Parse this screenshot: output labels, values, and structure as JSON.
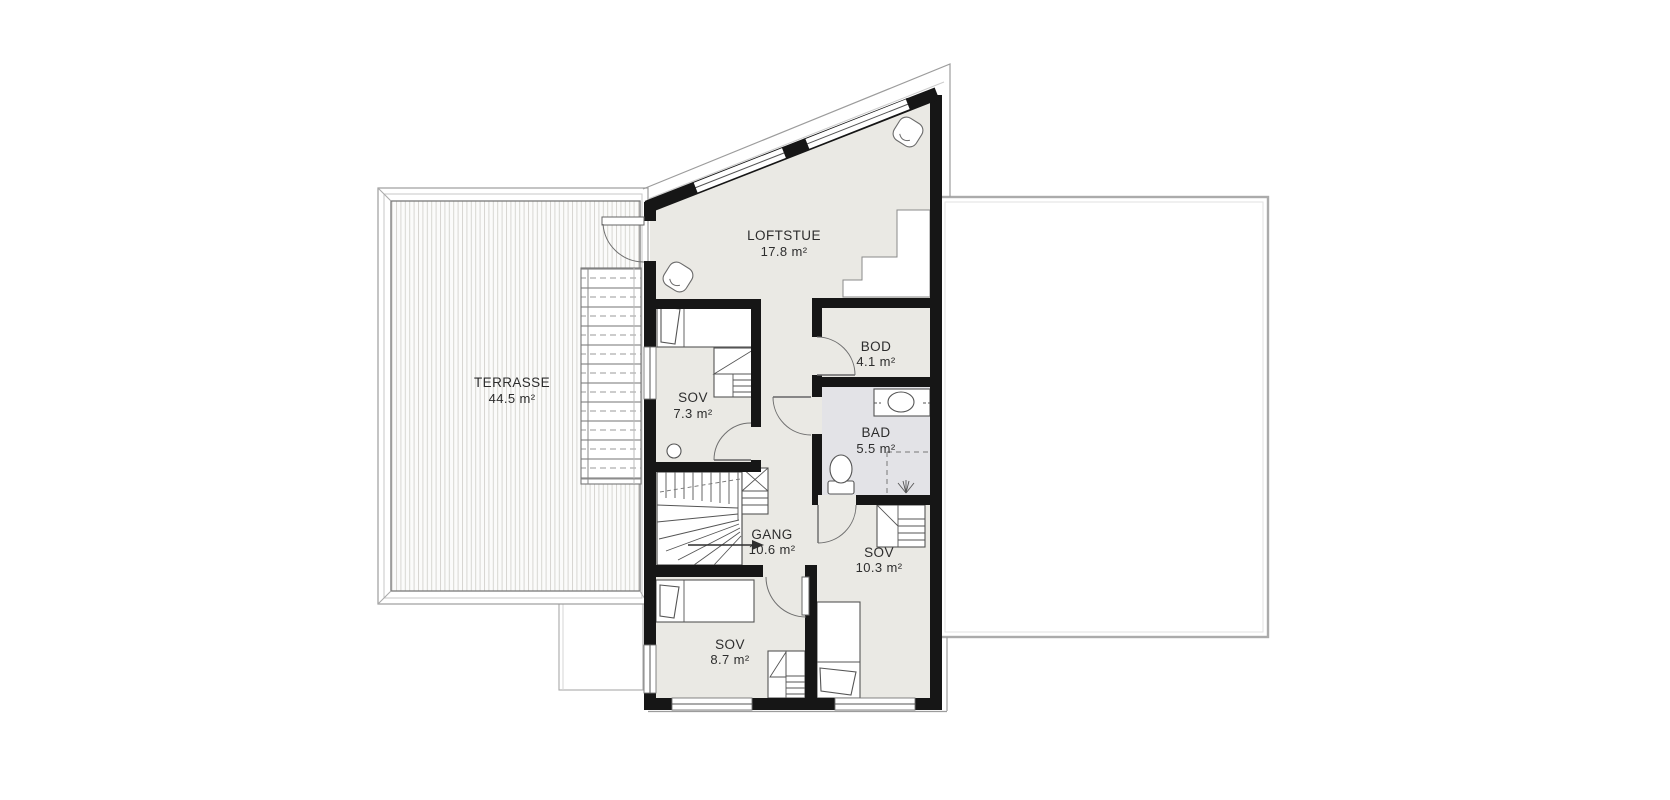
{
  "drawing": {
    "type": "architectural-floor-plan",
    "floor_fill": "#eae9e4",
    "bath_fill": "#e3e3e7",
    "wall_color": "#161616",
    "outline_color": "#9c9c9c"
  },
  "rooms": [
    {
      "id": "terrasse",
      "name": "TERRASSE",
      "area": "44.5 m²"
    },
    {
      "id": "loftstue",
      "name": "LOFTSTUE",
      "area": "17.8 m²"
    },
    {
      "id": "sov-1",
      "name": "SOV",
      "area": "7.3 m²"
    },
    {
      "id": "bod",
      "name": "BOD",
      "area": "4.1 m²"
    },
    {
      "id": "bad",
      "name": "BAD",
      "area": "5.5 m²"
    },
    {
      "id": "gang",
      "name": "GANG",
      "area": "10.6 m²"
    },
    {
      "id": "sov-2",
      "name": "SOV",
      "area": "10.3 m²"
    },
    {
      "id": "sov-3",
      "name": "SOV",
      "area": "8.7 m²"
    }
  ],
  "symbols": [
    "bed-icon",
    "wardrobe-icon",
    "toilet-icon",
    "sink-vanity-icon",
    "shower-head-icon",
    "ceiling-lamp-icon",
    "winder-stair-icon",
    "exterior-stair-icon",
    "door-swing-arc",
    "direction-arrow-icon",
    "smoke-detector-icon"
  ]
}
